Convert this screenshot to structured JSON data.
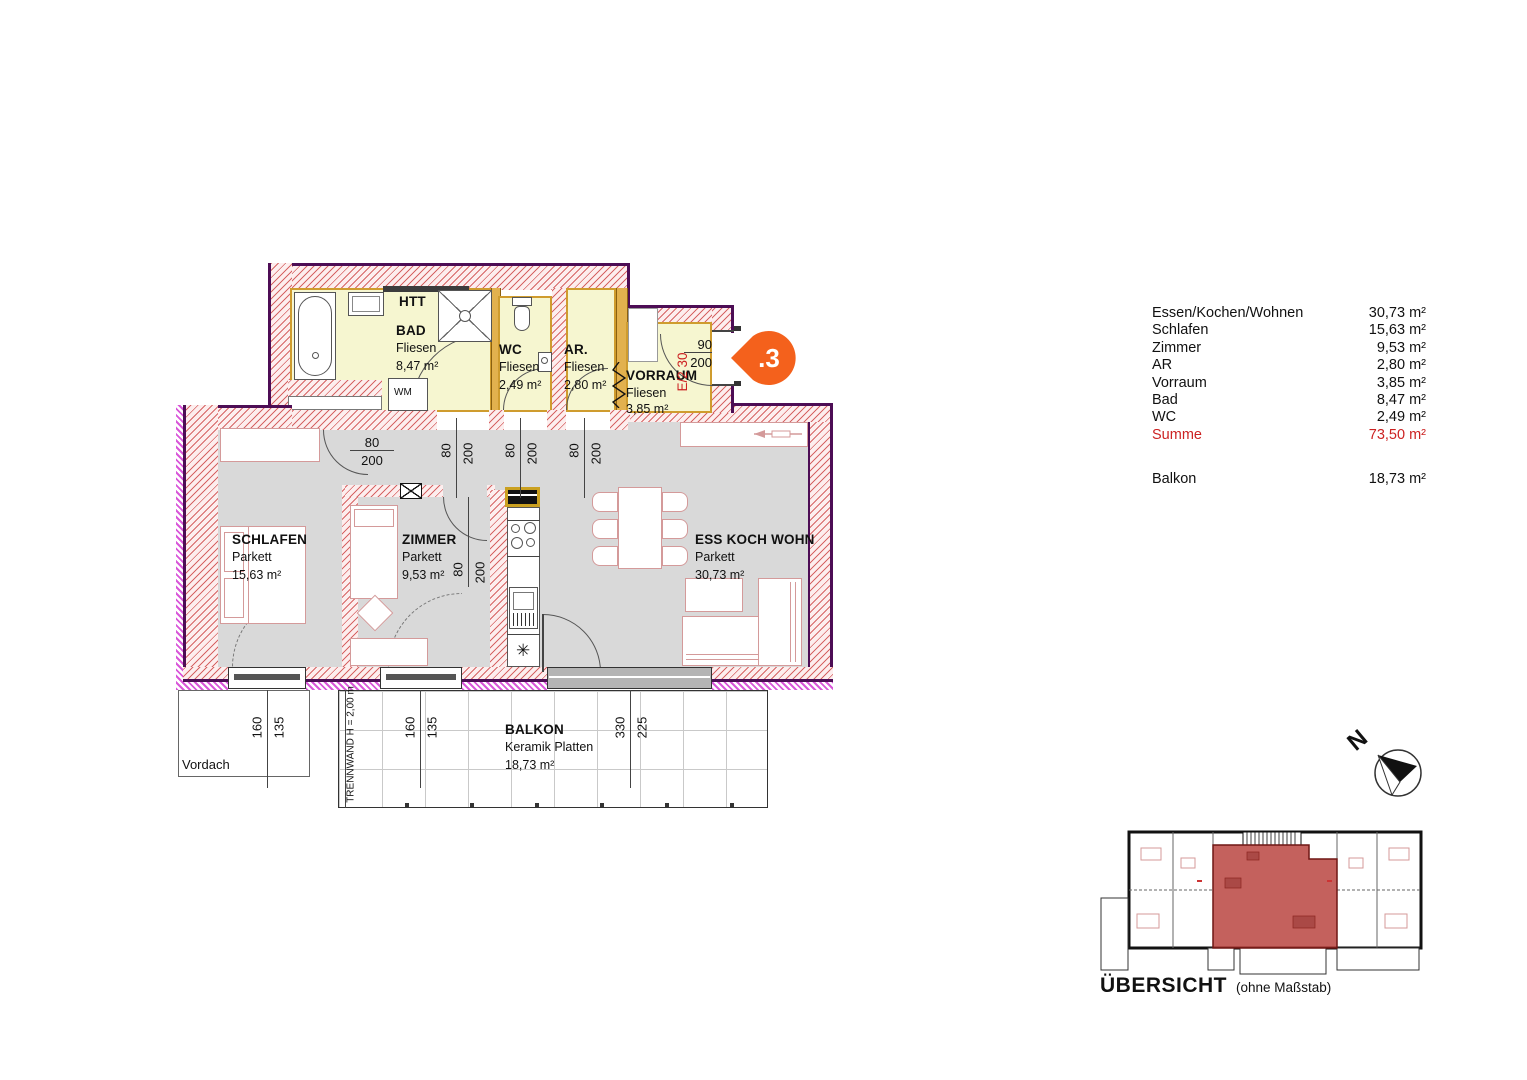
{
  "colors": {
    "wall_hatch": "#cc4242",
    "exterior_outline": "#4d0d55",
    "wet_room_floor": "#f6f6d0",
    "living_floor": "#d9d9d9",
    "insulation": "#d957d9",
    "furniture_outline": "#d49a9a",
    "badge_orange": "#f4611c",
    "highlight_red": "#cc2222",
    "overview_unit_fill": "#b43430"
  },
  "rooms": {
    "bad": {
      "name": "BAD",
      "floor": "Fliesen",
      "area": "8,47 m²"
    },
    "wc": {
      "name": "WC",
      "floor": "Fliesen",
      "area": "2,49 m²"
    },
    "ar": {
      "name": "AR.",
      "floor": "Fliesen",
      "area": "2,80 m²"
    },
    "vorraum": {
      "name": "VORRAUM",
      "floor": "Fliesen",
      "area": "3,85 m²"
    },
    "schlafen": {
      "name": "SCHLAFEN",
      "floor": "Parkett",
      "area": "15,63 m²"
    },
    "zimmer": {
      "name": "ZIMMER",
      "floor": "Parkett",
      "area": "9,53 m²"
    },
    "wohnen": {
      "name": "ESS KOCH WOHN",
      "floor": "Parkett",
      "area": "30,73 m²"
    },
    "balkon": {
      "name": "BALKON",
      "floor": "Keramik Platten",
      "area": "18,73 m²"
    }
  },
  "labels": {
    "htt": "HTT",
    "wm": "WM",
    "vordach": "Vordach",
    "trennwand": "TRENNWAND H = 2,00 m",
    "entry_code": "E/2 30",
    "unit_badge": ".3",
    "north": "N",
    "uebersicht": "ÜBERSICHT",
    "uebersicht_note": "(ohne Maßstab)"
  },
  "dims": {
    "door_bad": {
      "w": "80",
      "h": "200"
    },
    "door_wc": {
      "w": "80",
      "h": "200"
    },
    "door_ar": {
      "w": "80",
      "h": "200"
    },
    "door_schlafen": {
      "w": "80",
      "h": "200"
    },
    "door_zimmer": {
      "w": "80",
      "h": "200"
    },
    "door_entry": {
      "w": "90",
      "h": "200"
    },
    "win_schlafen": {
      "w": "160",
      "h": "135"
    },
    "win_zimmer": {
      "w": "160",
      "h": "135"
    },
    "win_wohnen": {
      "w": "330",
      "h": "225"
    }
  },
  "legend": {
    "rows": [
      {
        "label": "Essen/Kochen/Wohnen",
        "value": "30,73 m²"
      },
      {
        "label": "Schlafen",
        "value": "15,63 m²"
      },
      {
        "label": "Zimmer",
        "value": "9,53 m²"
      },
      {
        "label": "AR",
        "value": "2,80 m²"
      },
      {
        "label": "Vorraum",
        "value": "3,85 m²"
      },
      {
        "label": "Bad",
        "value": "8,47 m²"
      },
      {
        "label": "WC",
        "value": "2,49 m²"
      },
      {
        "label": "Summe",
        "value": "73,50 m²"
      }
    ],
    "balkon": {
      "label": "Balkon",
      "value": "18,73 m²"
    }
  }
}
